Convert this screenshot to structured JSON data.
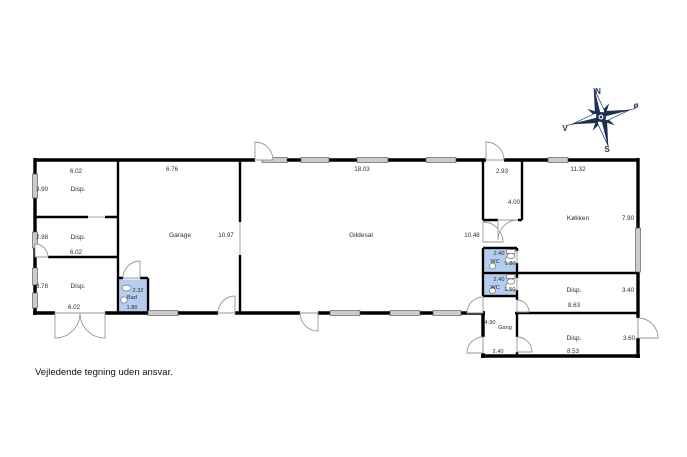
{
  "disclaimer": "Vejledende tegning uden ansvar.",
  "compass": {
    "n": "N",
    "e": "ø",
    "s": "S",
    "v": "V"
  },
  "colors": {
    "wall": "#000000",
    "window_fill": "#cccccc",
    "wet_room_fill": "#b3cdf0",
    "door_arc_stroke": "#969696",
    "compass_navy": "#1e3050"
  },
  "rooms": {
    "disp_nw": {
      "label": "Disp.",
      "dim_w": "6.02",
      "dim_h": "3.90"
    },
    "disp_w": {
      "label": "Disp.",
      "dim_w": "6.02",
      "dim_h": "2.98"
    },
    "disp_sw": {
      "label": "Disp.",
      "dim_w": "6.02",
      "dim_h": "3.78"
    },
    "bad": {
      "label": "Bad",
      "dim_w": "1.80",
      "dim_h": "2.32"
    },
    "garage": {
      "label": "Garage",
      "dim_w": "6.76",
      "dim_h": "10.97"
    },
    "gildesal": {
      "label": "Gildesal",
      "dim_w": "18.03",
      "dim_h": "10.48"
    },
    "entre": {
      "dim_w": "2.93",
      "dim_h": "4.00"
    },
    "kokken": {
      "label": "Køkken",
      "dim_w": "11.32",
      "dim_h": "7.90"
    },
    "wc_1": {
      "label": "WC",
      "dim_w": "2.40",
      "dim_h": "1.80"
    },
    "wc_2": {
      "label": "WC",
      "dim_w": "2.40",
      "dim_h": "1.50"
    },
    "disp_e1": {
      "label": "Disp.",
      "dim_w": "8.63",
      "dim_h": "3.40"
    },
    "gang": {
      "label": "Gang",
      "dim_w": "2.40",
      "dim_h": "4.90"
    },
    "disp_e2": {
      "label": "Disp.",
      "dim_w": "8.53",
      "dim_h": "3.60"
    }
  }
}
